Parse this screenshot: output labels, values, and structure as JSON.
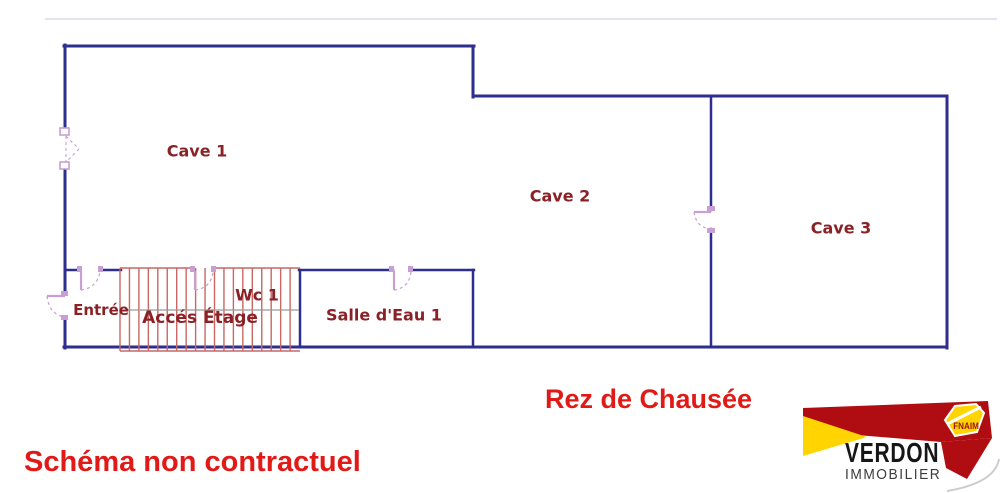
{
  "plan": {
    "rooms": [
      {
        "id": "cave-1",
        "label": "Cave 1"
      },
      {
        "id": "cave-2",
        "label": "Cave 2"
      },
      {
        "id": "cave-3",
        "label": "Cave 3"
      },
      {
        "id": "entree",
        "label": "Entrée"
      },
      {
        "id": "acces-etage",
        "label": "Accés Étage"
      },
      {
        "id": "wc-1",
        "label": "Wc 1"
      },
      {
        "id": "salle-eau-1",
        "label": "Salle d'Eau 1"
      }
    ]
  },
  "captions": {
    "floor_title": "Rez de Chausée",
    "disclaimer": "Schéma non contractuel"
  },
  "logo": {
    "brand": "VERDON",
    "tagline": "IMMOBILIER",
    "badge": "FNAIM"
  },
  "colors": {
    "wall": "#2e2e8e",
    "door_symbol": "#c79fd2",
    "stairs": "#c96763",
    "stairs_centerline": "#9a9a9a",
    "room_label": "#8a2126",
    "caption_red": "#e21a17",
    "logo_red": "#b00d12",
    "logo_yellow": "#ffd400",
    "logo_gray": "#3c3c3c"
  }
}
